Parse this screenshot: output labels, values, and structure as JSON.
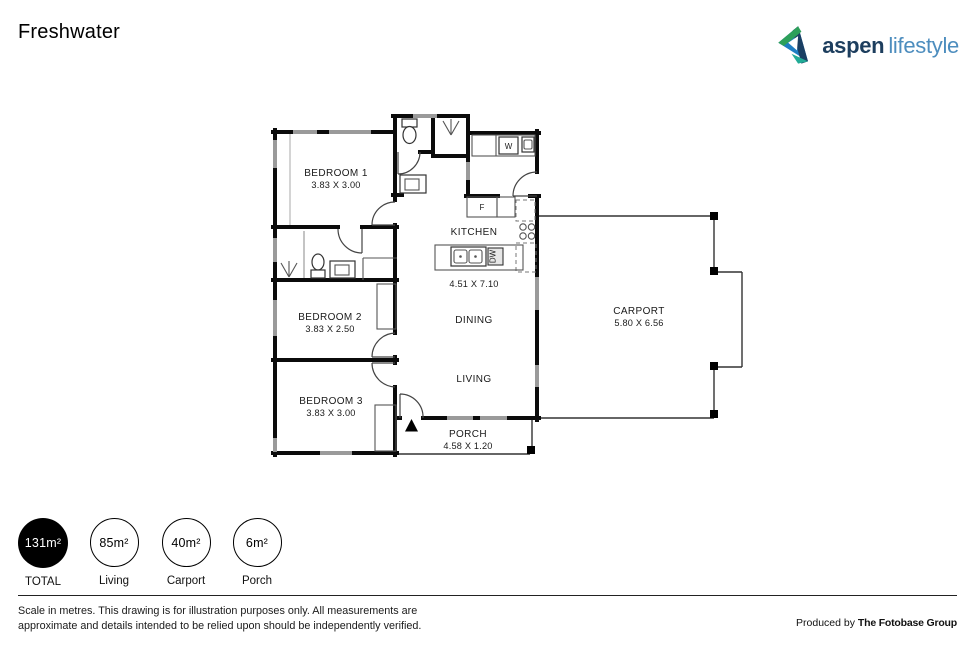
{
  "header": {
    "title": "Freshwater"
  },
  "logo": {
    "brand": "aspen",
    "suffix": "lifestyle",
    "colors": {
      "brand_navy": "#1d3e5e",
      "suffix_blue": "#4d8dbe",
      "icon_blue": "#1e7dc2",
      "icon_green": "#2da05a",
      "icon_teal": "#21ab96"
    }
  },
  "floorplan": {
    "rooms": {
      "bedroom1": {
        "name": "BEDROOM 1",
        "dims": "3.83 X 3.00"
      },
      "bedroom2": {
        "name": "BEDROOM 2",
        "dims": "3.83 X 2.50"
      },
      "bedroom3": {
        "name": "BEDROOM 3",
        "dims": "3.83 X 3.00"
      },
      "kitchen": {
        "name": "KITCHEN"
      },
      "open_plan": {
        "dims": "4.51 X 7.10"
      },
      "dining": {
        "name": "DINING"
      },
      "living": {
        "name": "LIVING"
      },
      "carport": {
        "name": "CARPORT",
        "dims": "5.80 X 6.56"
      },
      "porch": {
        "name": "PORCH",
        "dims": "4.58 X 1.20"
      }
    },
    "appliances": {
      "fridge": "F",
      "washer": "W",
      "dishwasher": "DW"
    }
  },
  "legend": {
    "items": [
      {
        "value": "131m²",
        "label": "TOTAL",
        "filled": true
      },
      {
        "value": "85m²",
        "label": "Living",
        "filled": false
      },
      {
        "value": "40m²",
        "label": "Carport",
        "filled": false
      },
      {
        "value": "6m²",
        "label": "Porch",
        "filled": false
      }
    ]
  },
  "footer": {
    "disclaimer_line1": "Scale in metres. This drawing is for illustration purposes only. All measurements are",
    "disclaimer_line2": "approximate and details intended to be relied upon should be independently verified.",
    "produced_by_prefix": "Produced by",
    "producer": "The Fotobase Group"
  }
}
